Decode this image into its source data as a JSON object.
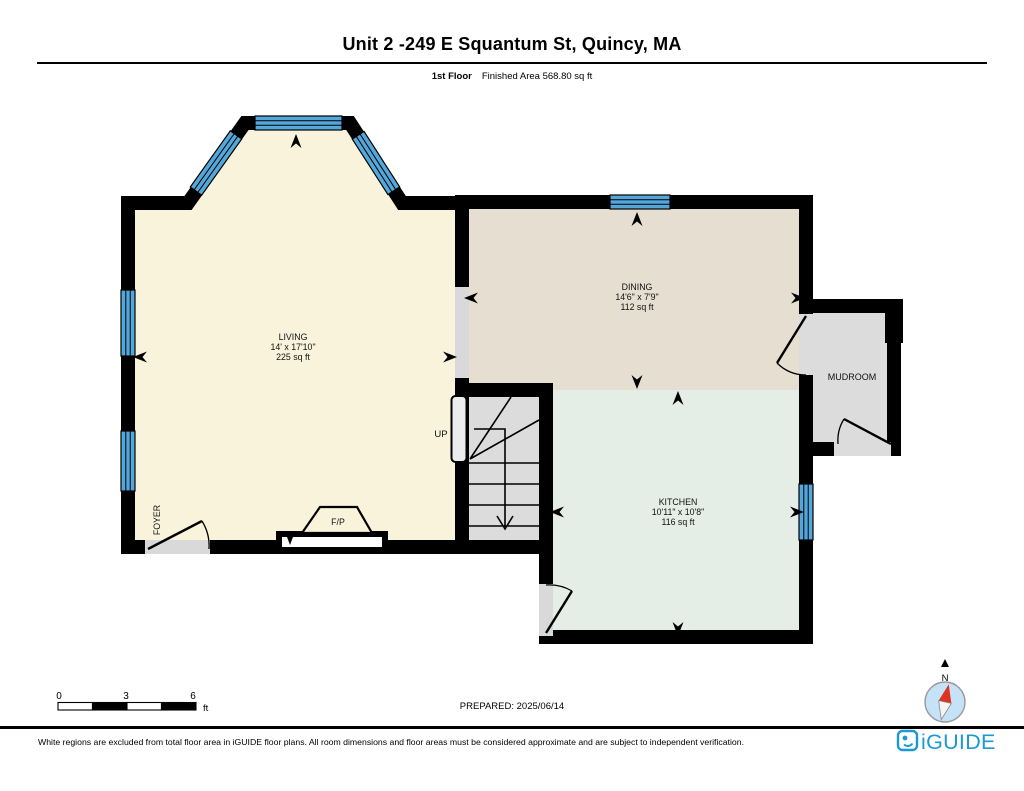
{
  "header": {
    "title": "Unit 2 -249 E Squantum St, Quincy, MA",
    "floor_label": "1st Floor",
    "area_label": "Finished Area 568.80 sq ft"
  },
  "rooms": {
    "living": {
      "name": "LIVING",
      "dimensions": "14' x 17'10\"",
      "area": "225 sq ft"
    },
    "dining": {
      "name": "DINING",
      "dimensions": "14'6\" x 7'9\"",
      "area": "112 sq ft"
    },
    "kitchen": {
      "name": "KITCHEN",
      "dimensions": "10'11\" x 10'8\"",
      "area": "116 sq ft"
    },
    "mudroom": {
      "name": "MUDROOM"
    },
    "foyer": {
      "name": "FOYER"
    }
  },
  "annotations": {
    "stairs_up": "UP",
    "fireplace": "F/P"
  },
  "scale_bar": {
    "tick_0": "0",
    "tick_3": "3",
    "tick_6": "6",
    "unit": "ft"
  },
  "prepared": "PREPARED: 2025/06/14",
  "compass": {
    "north_label": "N"
  },
  "footer": {
    "disclaimer": "White regions are excluded from total floor area in iGUIDE floor plans. All room dimensions and floor areas must be considered approximate and are subject to independent verification.",
    "brand": "iGUIDE"
  },
  "colors": {
    "living": "#FAF3DC",
    "dining": "#E6DED1",
    "kitchen": "#E4EEE7",
    "gray_room": "#DCDCDC",
    "opening": "#D9D9D9",
    "wall": "#000000",
    "window_blue": "#54A7DA",
    "brand_blue": "#1B99D6",
    "compass_fill": "#C5E2F7",
    "needle_red": "#DD3322"
  }
}
